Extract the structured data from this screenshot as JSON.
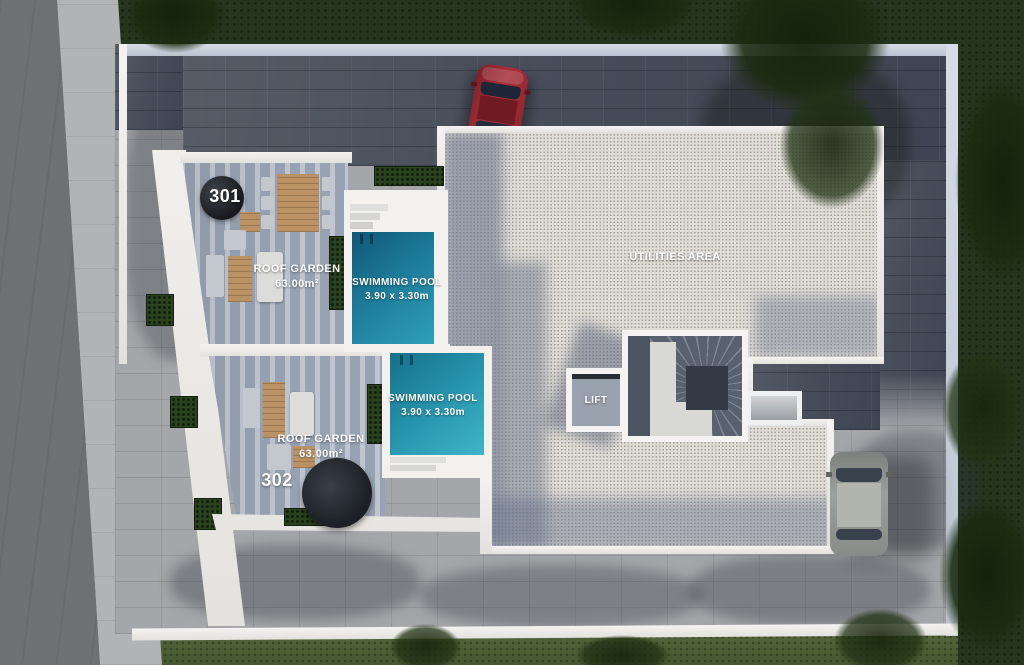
{
  "plan": {
    "unit_301": {
      "number": "301",
      "garden_label": "ROOF GARDEN",
      "garden_area": "63.00m²"
    },
    "unit_302": {
      "number": "302",
      "garden_label": "ROOF GARDEN",
      "garden_area": "63.00m²"
    },
    "pool_301": {
      "label": "SWIMMING POOL",
      "dimensions": "3.90 x 3.30m"
    },
    "pool_302": {
      "label": "SWIMMING POOL",
      "dimensions": "3.90 x 3.30m"
    },
    "utilities_label": "UTILITIES AREA",
    "lift_label": "LIFT",
    "colors": {
      "pool_water": "#2794ad",
      "deck": "#97a2b2",
      "gravel": "#e0ddd8",
      "dark_pavers": "#474d59",
      "light_pavers": "#a4a6a9",
      "grass": "#26351e",
      "wall": "#f2f1ee"
    }
  }
}
